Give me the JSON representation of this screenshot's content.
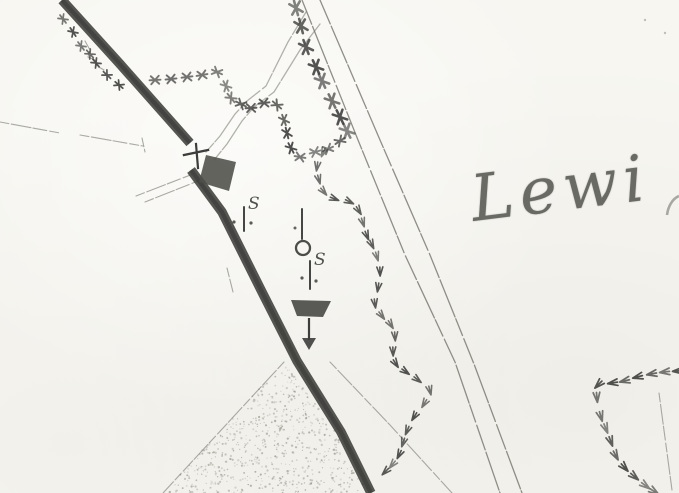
{
  "title": "Scanned historical map fragment",
  "palette": {
    "paper": "#f7f6f1",
    "ink": "#3d3d3b",
    "ink_dark": "#2e2e2c",
    "ink_faint": "#8b8b84",
    "road_line": "#74746d",
    "stipple": "#8e8e86",
    "label_ink": "#4c4c47"
  },
  "labels": {
    "place": {
      "visible_part": "Lewi",
      "rotation_deg": -7
    }
  },
  "roads": {
    "thick_upper": {
      "points": [
        [
          62,
          0
        ],
        [
          120,
          64
        ],
        [
          190,
          143
        ]
      ],
      "width": 9.5
    },
    "thick_lower": {
      "points": [
        [
          191,
          170
        ],
        [
          222,
          212
        ],
        [
          262,
          292
        ],
        [
          297,
          361
        ],
        [
          341,
          432
        ],
        [
          371,
          493
        ]
      ],
      "width": 9.5
    },
    "main_double": {
      "left": [
        [
          302,
          0
        ],
        [
          358,
          140
        ],
        [
          405,
          255
        ],
        [
          455,
          362
        ],
        [
          500,
          493
        ]
      ],
      "right": [
        [
          320,
          0
        ],
        [
          380,
          140
        ],
        [
          430,
          255
        ],
        [
          474,
          364
        ],
        [
          522,
          493
        ]
      ]
    },
    "branch_double": {
      "left": [
        [
          306,
          12
        ],
        [
          288,
          42
        ],
        [
          266,
          86
        ],
        [
          247,
          101
        ],
        [
          235,
          114
        ],
        [
          220,
          136
        ],
        [
          206,
          152
        ]
      ],
      "right": [
        [
          320,
          24
        ],
        [
          300,
          50
        ],
        [
          274,
          92
        ],
        [
          254,
          107
        ],
        [
          242,
          121
        ],
        [
          227,
          144
        ],
        [
          214,
          160
        ]
      ]
    }
  },
  "field_lines": [
    {
      "name": "west-line-a",
      "points": [
        [
          0,
          122
        ],
        [
          60,
          133
        ]
      ]
    },
    {
      "name": "west-line-b",
      "points": [
        [
          80,
          135
        ],
        [
          143,
          146
        ]
      ]
    },
    {
      "name": "west-line-b-tick",
      "points": [
        [
          142,
          138
        ],
        [
          145,
          152
        ]
      ]
    },
    {
      "name": "approach-line-1",
      "points": [
        [
          136,
          196
        ],
        [
          193,
          174
        ]
      ]
    },
    {
      "name": "approach-line-2",
      "points": [
        [
          145,
          202
        ],
        [
          198,
          181
        ]
      ]
    },
    {
      "name": "northwest-squiggle",
      "points": [
        [
          85,
          41
        ],
        [
          90,
          50
        ],
        [
          88,
          57
        ],
        [
          95,
          60
        ],
        [
          97,
          66
        ],
        [
          104,
          70
        ]
      ]
    },
    {
      "name": "roadside-dashes",
      "points": [
        [
          227,
          268
        ],
        [
          233,
          292
        ]
      ]
    },
    {
      "name": "southeast-diagonal",
      "points": [
        [
          330,
          362
        ],
        [
          390,
          425
        ],
        [
          452,
          493
        ]
      ]
    },
    {
      "name": "east-edge-line",
      "points": [
        [
          659,
          393
        ],
        [
          672,
          490
        ]
      ]
    },
    {
      "name": "plantation-edge",
      "points": [
        [
          284,
          362
        ],
        [
          163,
          493
        ]
      ]
    }
  ],
  "tree_chains": [
    {
      "name": "upper-left-road-hedge",
      "mark": "cross",
      "size": 0.9,
      "points": [
        [
          63,
          19
        ],
        [
          73,
          32
        ],
        [
          81,
          46
        ],
        [
          90,
          54
        ],
        [
          96,
          63
        ],
        [
          107,
          75
        ],
        [
          119,
          85
        ]
      ]
    },
    {
      "name": "north-field-boundary",
      "mark": "cross",
      "size": 1.0,
      "points": [
        [
          155,
          80
        ],
        [
          171,
          79
        ],
        [
          187,
          77
        ],
        [
          202,
          75
        ],
        [
          217,
          72
        ],
        [
          226,
          86
        ],
        [
          231,
          98
        ],
        [
          241,
          104
        ],
        [
          251,
          108
        ],
        [
          264,
          103
        ],
        [
          277,
          105
        ],
        [
          284,
          120
        ],
        [
          287,
          133
        ],
        [
          291,
          148
        ],
        [
          300,
          157
        ],
        [
          315,
          152
        ],
        [
          328,
          149
        ],
        [
          340,
          141
        ]
      ]
    },
    {
      "name": "main-road-west-hedge",
      "mark": "cross",
      "size": 1.35,
      "points": [
        [
          296,
          8
        ],
        [
          301,
          26
        ],
        [
          306,
          47
        ],
        [
          316,
          67
        ],
        [
          322,
          81
        ],
        [
          332,
          101
        ],
        [
          340,
          117
        ],
        [
          347,
          131
        ]
      ]
    },
    {
      "name": "long-curved-boundary",
      "mark": "bird",
      "size": 1.0,
      "points": [
        [
          323,
          153
        ],
        [
          317,
          167
        ],
        [
          319,
          180
        ],
        [
          324,
          192
        ],
        [
          335,
          199
        ],
        [
          350,
          202
        ],
        [
          359,
          211
        ],
        [
          363,
          223
        ],
        [
          367,
          236
        ],
        [
          372,
          245
        ],
        [
          377,
          257
        ],
        [
          380,
          272
        ],
        [
          378,
          288
        ],
        [
          375,
          304
        ],
        [
          382,
          316
        ],
        [
          391,
          325
        ],
        [
          395,
          337
        ],
        [
          393,
          352
        ],
        [
          396,
          364
        ],
        [
          406,
          372
        ],
        [
          418,
          380
        ],
        [
          430,
          391
        ],
        [
          424,
          404
        ],
        [
          414,
          417
        ],
        [
          407,
          431
        ],
        [
          403,
          443
        ],
        [
          399,
          455
        ],
        [
          392,
          465
        ],
        [
          385,
          472
        ]
      ]
    },
    {
      "name": "southeast-v-boundary",
      "mark": "bird",
      "size": 1.1,
      "points": [
        [
          677,
          371
        ],
        [
          664,
          372
        ],
        [
          651,
          374
        ],
        [
          637,
          377
        ],
        [
          624,
          381
        ],
        [
          612,
          383
        ],
        [
          598,
          385
        ],
        [
          597,
          398
        ],
        [
          601,
          417
        ],
        [
          606,
          429
        ],
        [
          611,
          442
        ],
        [
          616,
          456
        ],
        [
          625,
          468
        ],
        [
          635,
          477
        ],
        [
          646,
          486
        ],
        [
          655,
          492
        ]
      ]
    }
  ],
  "stipple_area": {
    "points": [
      [
        284,
        362
      ],
      [
        336,
        432
      ],
      [
        367,
        493
      ],
      [
        163,
        493
      ]
    ]
  },
  "symbols": {
    "stone_marker_1": {
      "label": "S",
      "stem": [
        [
          244,
          207
        ],
        [
          244,
          231
        ]
      ],
      "dots": [
        [
          234,
          222
        ],
        [
          251,
          223
        ]
      ],
      "label_pos": [
        248,
        209
      ]
    },
    "well": {
      "stem": [
        [
          302,
          209
        ],
        [
          302,
          239
        ]
      ],
      "dot": [
        295,
        228
      ],
      "circle": {
        "cx": 303,
        "cy": 248,
        "r": 7
      }
    },
    "stone_marker_2": {
      "label": "S",
      "stem": [
        [
          310,
          261
        ],
        [
          310,
          289
        ]
      ],
      "dots": [
        [
          302,
          278
        ],
        [
          316,
          281
        ]
      ],
      "label_pos": [
        314,
        265
      ]
    },
    "trough": {
      "poly": [
        [
          291,
          300
        ],
        [
          331,
          301
        ],
        [
          323,
          317
        ],
        [
          297,
          316
        ]
      ],
      "stem": [
        [
          309,
          318
        ],
        [
          309,
          340
        ]
      ],
      "arrow": [
        [
          302,
          338
        ],
        [
          316,
          338
        ],
        [
          309,
          350
        ]
      ]
    },
    "gate": {
      "bar": [
        [
          184,
          155
        ],
        [
          208,
          150
        ]
      ],
      "stem": [
        [
          196,
          144
        ],
        [
          198,
          168
        ]
      ]
    },
    "building": {
      "poly": [
        [
          206,
          155
        ],
        [
          236,
          162
        ],
        [
          229,
          191
        ],
        [
          199,
          182
        ]
      ]
    }
  },
  "specks": [
    [
      645,
      20
    ],
    [
      665,
      33
    ]
  ]
}
